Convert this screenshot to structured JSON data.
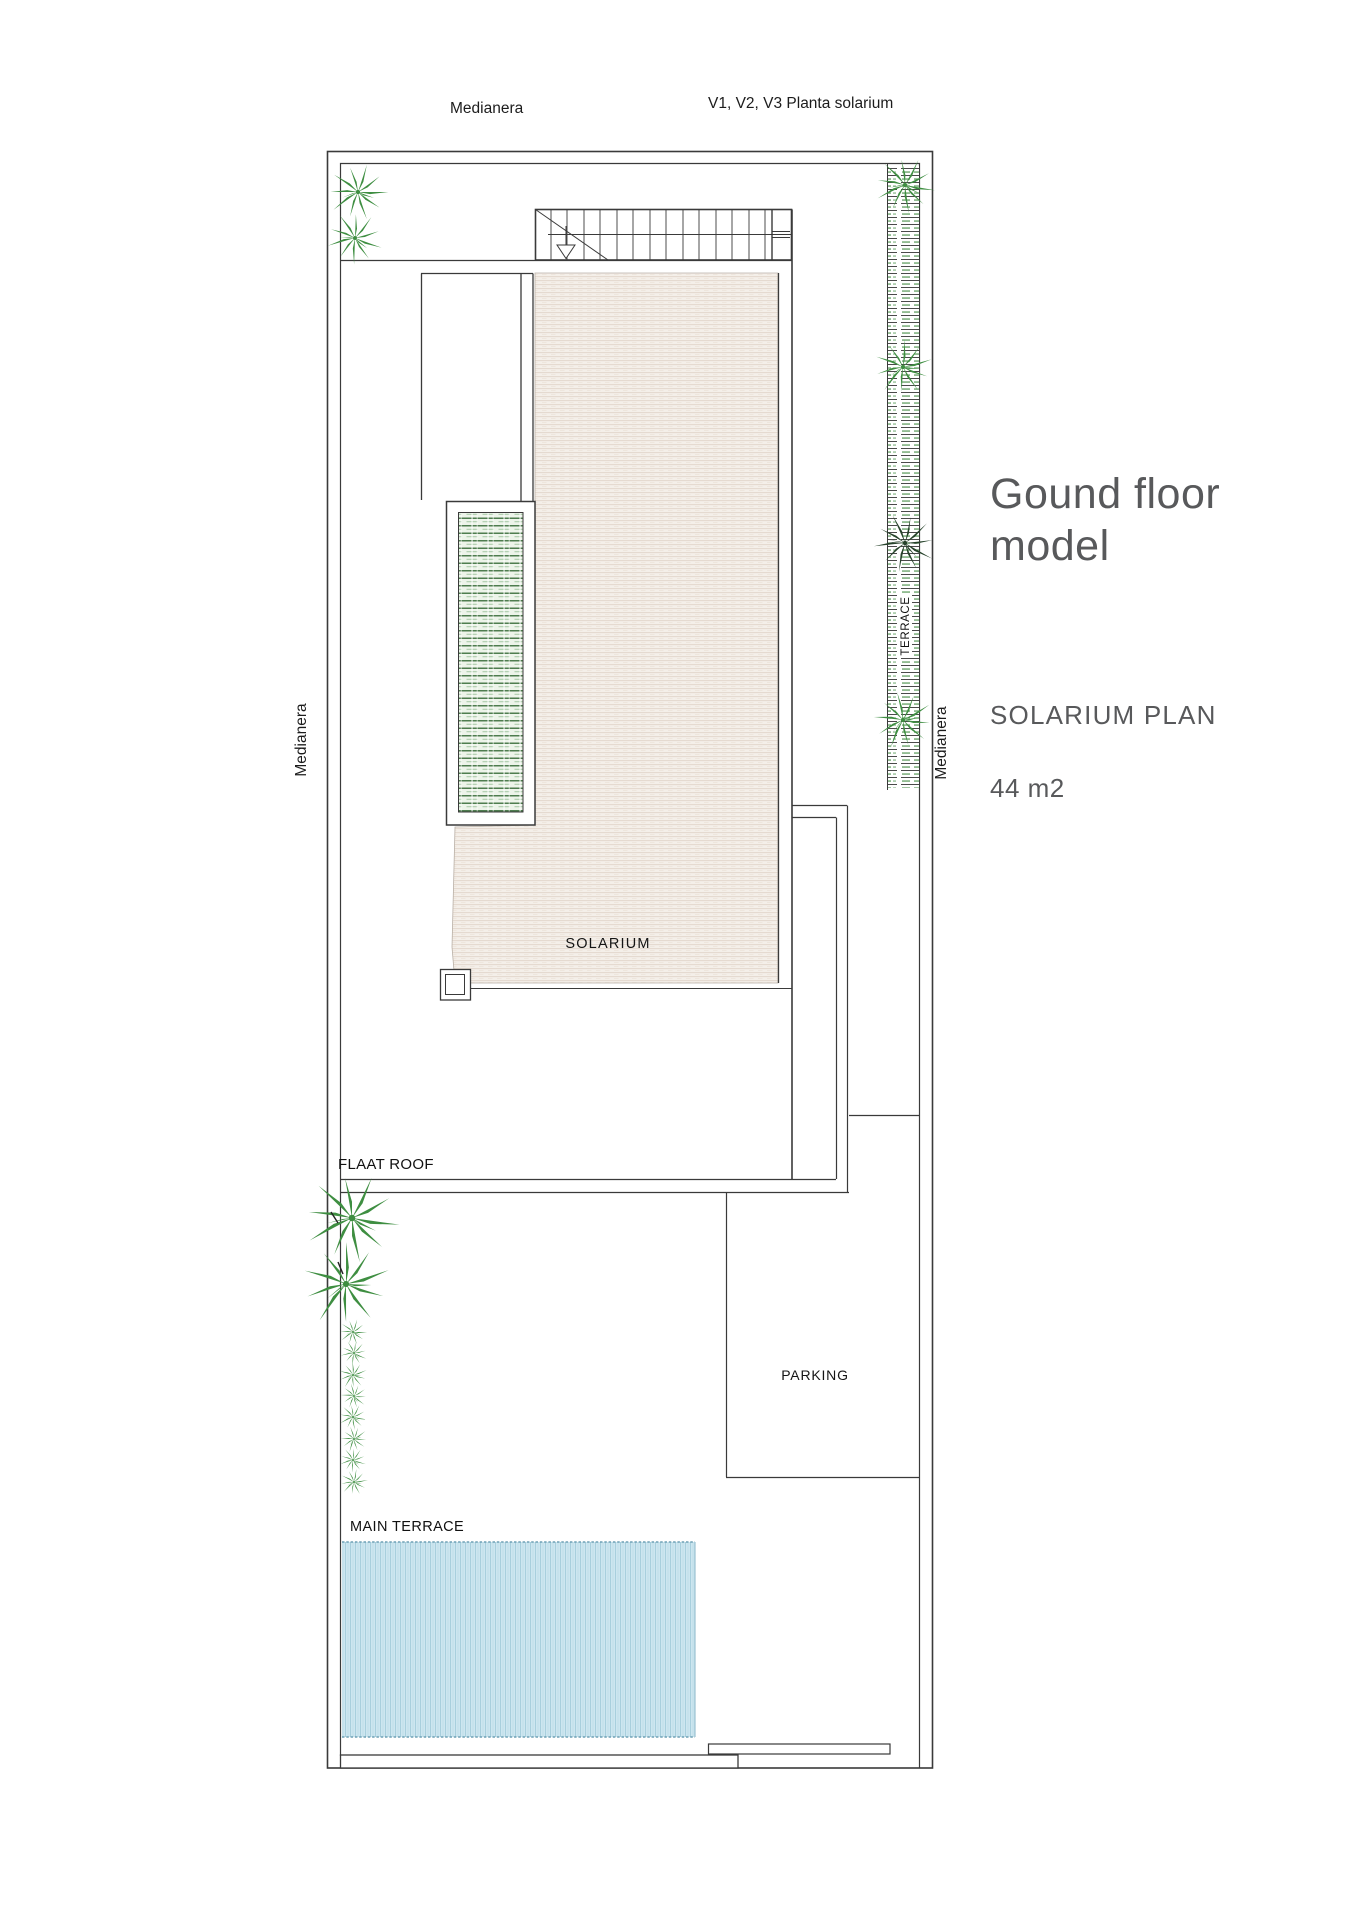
{
  "annotations": {
    "top_left": "Medianera",
    "top_right": "V1, V2, V3 Planta solarium",
    "left_side": "Medianera",
    "right_side": "Medianera"
  },
  "plan": {
    "terrace": "TERRACE",
    "solarium": "SOLARIUM",
    "flat_roof": "FLAAT ROOF",
    "parking": "PARKING",
    "main_terrace": "MAIN TERRACE"
  },
  "legend": {
    "title_line1": "Gound floor",
    "title_line2": "model",
    "subtitle": "SOLARIUM PLAN",
    "area": "44 m2"
  },
  "colors": {
    "line": "#3a3a3a",
    "title_text": "#58595b",
    "label_text": "#1c1c1c",
    "solarium_fill": "#f3eee8",
    "solarium_hatch_line": "#e4d9cf",
    "pergola_green": "#4e7d4f",
    "terrace_hatch_green": "#63a063",
    "palm_green": "#3e8e41",
    "palm_dark": "#26422a",
    "pool_fill": "#cde6f0",
    "pool_stripe": "#a8cfdd"
  }
}
